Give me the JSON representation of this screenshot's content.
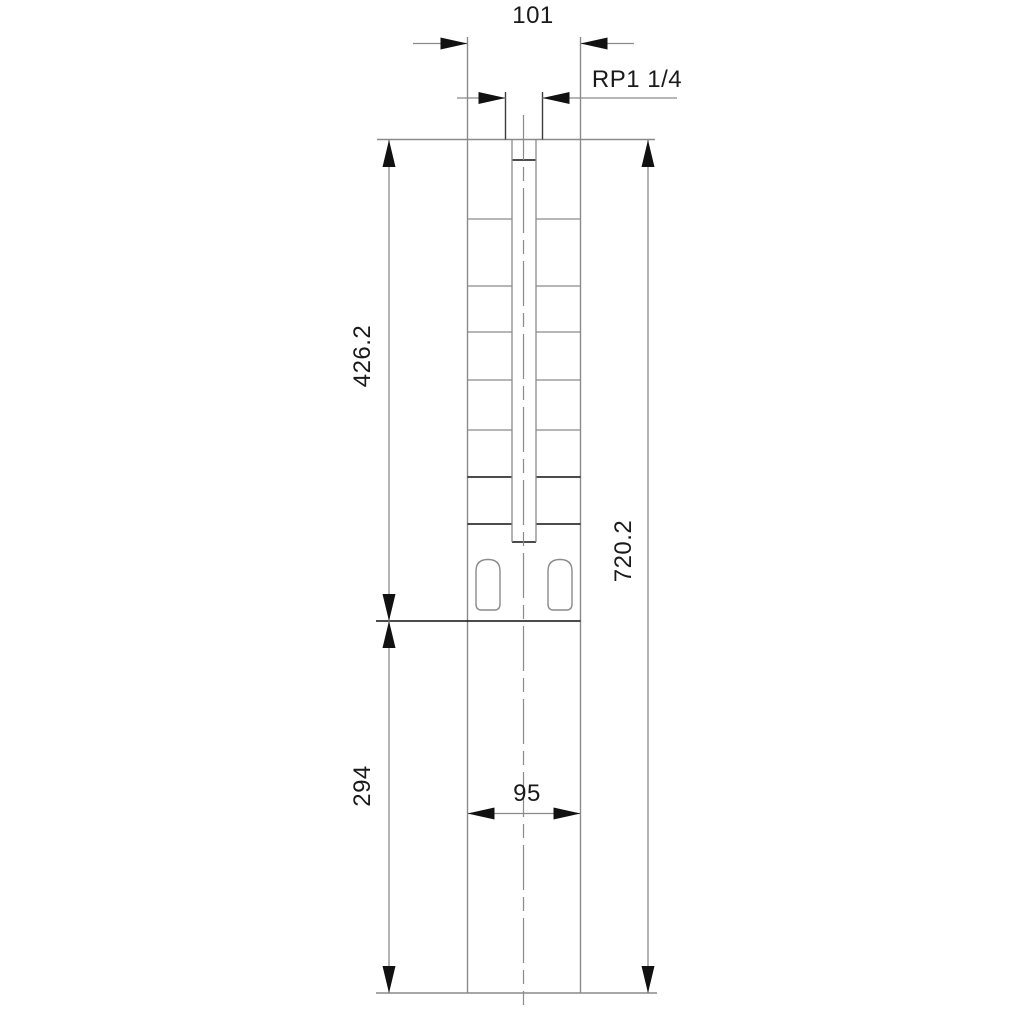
{
  "drawing": {
    "type": "technical-dimensional-drawing",
    "dimensions": {
      "outlet_flange_width": "101",
      "outlet_thread": "RP1 1/4",
      "pump_section_height": "426.2",
      "total_height": "720.2",
      "motor_section_height": "294",
      "motor_width": "95"
    },
    "colors": {
      "line_gray": "#8a8a8a",
      "line_black": "#111111",
      "stub_dark": "#3c3c3c",
      "text": "#1a1a1a",
      "background": "#ffffff"
    }
  }
}
